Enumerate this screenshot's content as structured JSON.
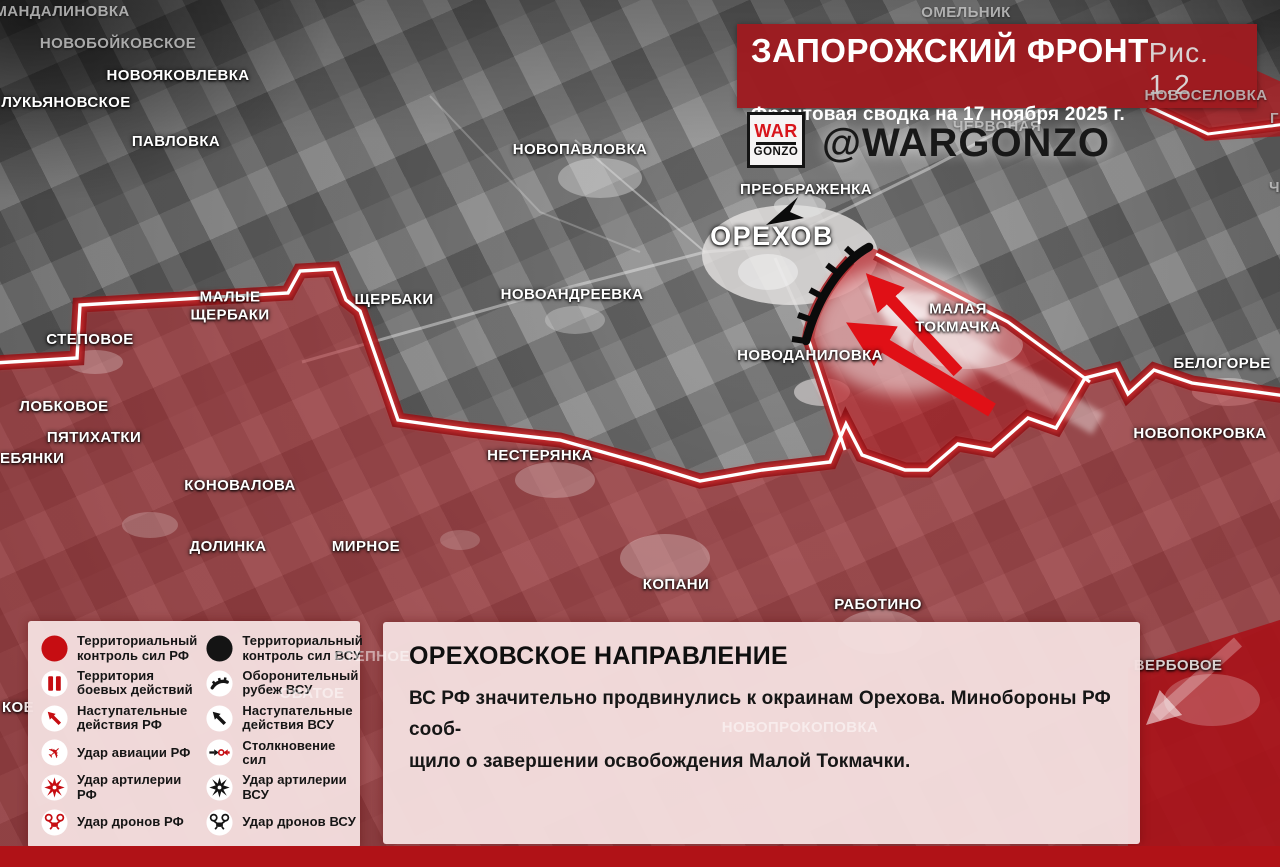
{
  "header": {
    "title": "ЗАПОРОЖСКИЙ ФРОНТ",
    "figure": "Рис. 1.2",
    "subtitle": "Фронтовая сводка на 17 ноября 2025 г.",
    "logo_line1": "WAR",
    "logo_line2": "GONZO",
    "handle": "@WARGONZO"
  },
  "colors": {
    "banner_red": "#9e1b20",
    "rf_red": "#c60d12",
    "vsu_black": "#141414",
    "combat_band": "#870c11",
    "front_line": "#ffffff",
    "panel_pink": "#f4dfdf",
    "solid_red": "#b01217"
  },
  "map": {
    "towns": [
      "МАНДАЛИНОВКА",
      "НОВОБОЙКОВСКОЕ",
      "ОМЕЛЬНИК",
      "НОВОСЕЛОВКА",
      "ЧЕРВОНАЯ",
      "НОВОЯКОВЛЕВКА",
      "ЛУКЬЯНОВСКОЕ",
      "ПАВЛОВКА",
      "НОВОПАВЛОВКА",
      "ПРЕОБРАЖЕНКА",
      "ОРЕХОВ",
      "ЩЕРБАКИ",
      "НОВОАНДРЕЕВКА",
      "МАЛЫЕ\nЩЕРБАКИ",
      "СТЕПОВОЕ",
      "НОВОДАНИЛОВКА",
      "МАЛАЯ\nТОКМАЧКА",
      "БЕЛОГОРЬЕ",
      "ЛОБКОВОЕ",
      "ПЯТИХАТКИ",
      "ЕБЯНКИ",
      "НОВОПОКРОВКА",
      "КОНОВАЛОВА",
      "НЕСТЕРЯНКА",
      "ДОЛИНКА",
      "МИРНОЕ",
      "КОПАНИ",
      "РАБОТИНО",
      "ВЕРБОВОЕ",
      "НОВОПРОКОПОВКА",
      "СТЕПНОЕ",
      "ОВАТОЕ",
      "КОЕ",
      "Г",
      "Ч"
    ]
  },
  "legend": {
    "icons": {
      "rf_control": "filled-red-circle",
      "vsu_control": "filled-black-circle",
      "combat_zone": "red-double-bars",
      "vsu_defense": "black-toothed-arc",
      "rf_offense": "red-diagonal-arrow",
      "vsu_offense": "black-diagonal-arrow",
      "rf_aviation": "red-plane",
      "clash": "opposing-arrows-with-ring",
      "rf_artillery": "red-burst",
      "vsu_artillery": "black-burst",
      "rf_drone": "red-quadcopter",
      "vsu_drone": "black-quadcopter"
    },
    "items": [
      "Территориальный контроль сил РФ",
      "Территориальный контроль сил ВСУ",
      "Территория боевых действий",
      "Оборонительный рубеж ВСУ",
      "Наступательные действия РФ",
      "Наступательные действия ВСУ",
      "Удар авиации РФ",
      "Столкновение сил",
      "Удар артилерии РФ",
      "Удар артилерии ВСУ",
      "Удар дронов РФ",
      "Удар дронов ВСУ"
    ]
  },
  "info_box": {
    "title": "ОРЕХОВСКОЕ НАПРАВЛЕНИЕ",
    "line1": "ВС РФ значительно продвинулись к окраинам Орехова. Минобороны РФ сооб-",
    "line2": "щило о завершении освобождения Малой Токмачки."
  }
}
